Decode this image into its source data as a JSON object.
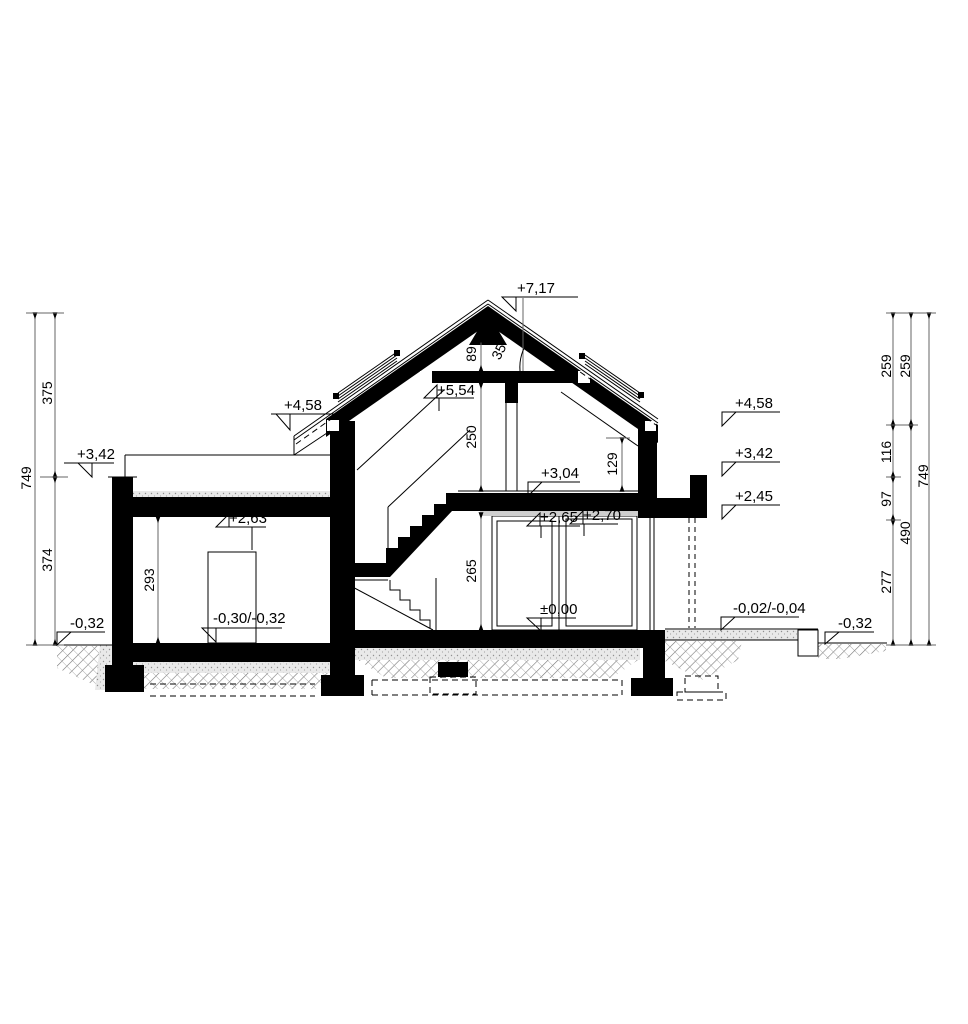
{
  "drawing": {
    "title": "House cross-section",
    "levels": {
      "ridge": "+7,17",
      "collar_ceiling": "+5,54",
      "eaves_left": "+4,58",
      "eaves_right": "+4,58",
      "flat_roof_left": "+3,42",
      "flat_roof_right": "+3,42",
      "attic_floor": "+3,04",
      "garage_ceiling": "+2,63",
      "glazing_top_left": "+2,65",
      "glazing_top_right": "+2,70",
      "canopy_underside": "+2,45",
      "ground_floor": "±0,00",
      "garage_floor": "-0,30/-0,32",
      "terrace": "-0,02/-0,04",
      "grade_left": "-0,32",
      "grade_right": "-0,32"
    },
    "dimensions": {
      "left": {
        "overall": "749",
        "upper": "375",
        "lower": "374"
      },
      "right_inner": [
        "259",
        "116",
        "97",
        "277"
      ],
      "right_middle": [
        "259",
        "490"
      ],
      "right_outer": "749",
      "interior": {
        "ridge_to_collar": "89",
        "roof_angle": "35°",
        "attic_room_height": "250",
        "knee_height": "129",
        "ground_room_height": "265",
        "garage_room_height": "293"
      }
    }
  }
}
